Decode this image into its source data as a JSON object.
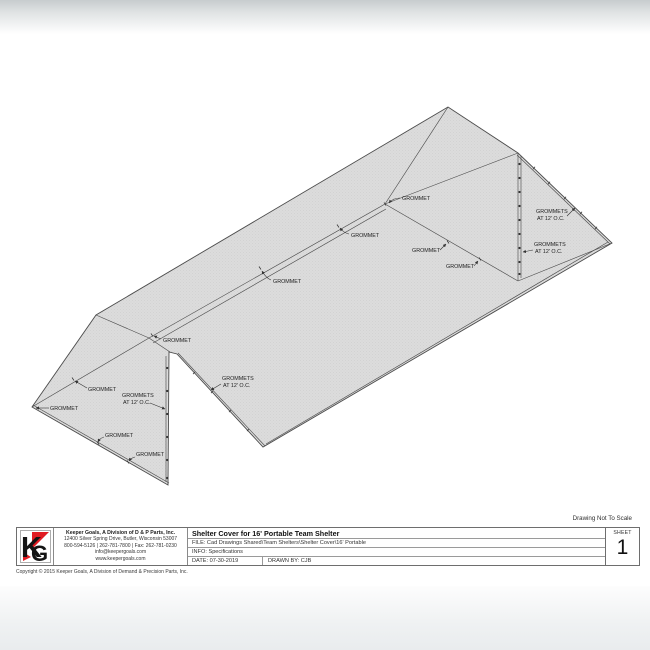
{
  "header": {
    "scale_note": "Drawing Not To Scale"
  },
  "drawing": {
    "callouts": {
      "grommet": "GROMMET",
      "grommets_line1": "GROMMETS",
      "grommets_line2": "AT 12' O.C."
    },
    "colors": {
      "cover_fill": "#dcdcdc",
      "line": "#4c4c4c",
      "logo_red": "#e01b22",
      "logo_black": "#141414"
    }
  },
  "title_block": {
    "logo": {
      "k": "K",
      "g": "G"
    },
    "company": {
      "name": "Keeper Goals, A Division of D & P Parts, Inc.",
      "address": "12400 Silver Spring Drive, Butler, Wisconsin 53007",
      "phone": "800-594-5126 | 262-781-7800 | Fax: 262-781-0230",
      "email": "info@keepergoals.com",
      "website": "www.keepergoals.com"
    },
    "title": "Shelter Cover for 16' Portable Team Shelter",
    "file": "FILE: Cad Drawings Shared\\Team Shelters\\Shelter Cover\\16' Portable",
    "info": "INFO: Specifications",
    "date": "DATE: 07-30-2019",
    "drawn_by": "DRAWN BY: CJB",
    "sheet_label": "SHEET",
    "sheet_number": "1"
  },
  "footer": {
    "copyright": "Copyright © 2015 Keeper Goals, A Division of Demand & Precision Parts, Inc."
  }
}
